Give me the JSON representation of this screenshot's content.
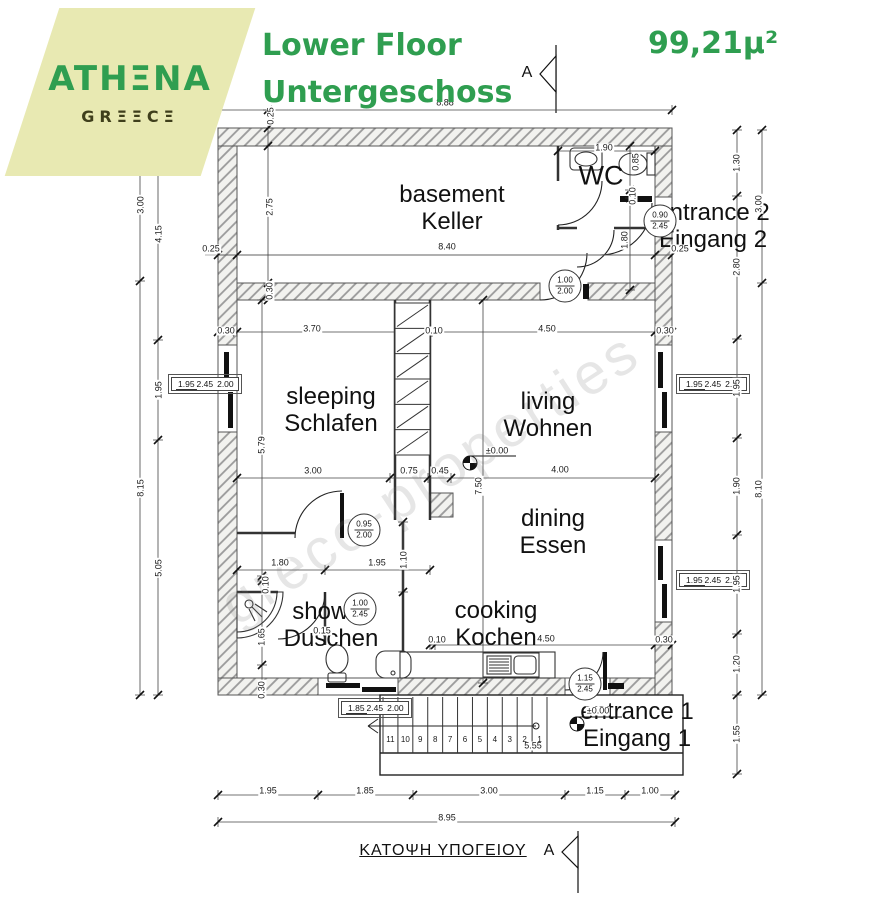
{
  "header": {
    "logo_line1": "ATHΞNA",
    "logo_line2": "GRΞΞCΞ",
    "title_line1": "Lower Floor",
    "title_line2": "Untergeschoss",
    "area": "99,21μ²"
  },
  "colors": {
    "accent_green": "#2f9e50",
    "logo_bg": "#e8e9b2",
    "logo_sub": "#3f3f1c"
  },
  "section_marker": {
    "top": "A",
    "bottom": "A"
  },
  "caption": "ΚΑΤΟΨΗ ΥΠΟΓΕΙΟΥ",
  "watermark": "greco-properties",
  "rooms": [
    {
      "en": "basement",
      "de": "Keller"
    },
    {
      "en": "WC",
      "de": ""
    },
    {
      "en": "entrance 2",
      "de": "Eingang 2"
    },
    {
      "en": "sleeping",
      "de": "Schlafen"
    },
    {
      "en": "living",
      "de": "Wohnen"
    },
    {
      "en": "dining",
      "de": "Essen"
    },
    {
      "en": "shower",
      "de": "Duschen"
    },
    {
      "en": "cooking",
      "de": "Kochen"
    },
    {
      "en": "entrance 1",
      "de": "Eingang 1"
    }
  ],
  "dim_labels": [
    "8.88",
    "0.25",
    "3.00",
    "8.15",
    "4.15",
    "1.95",
    "5.05",
    "2.75",
    "0.30",
    "0.25",
    "8.40",
    "0.30",
    "3.70",
    "0.10",
    "4.50",
    "0.30",
    "5.79",
    "3.00",
    "0.75",
    "0.45",
    "4.00",
    "7.50",
    "1.80",
    "1.95",
    "1.10",
    "0.10",
    "1.65",
    "0.30",
    "0.15",
    "0.10",
    "4.50",
    "0.30",
    "1.90",
    "0.85",
    "0.10",
    "1.80",
    "0.25",
    "1.30",
    "2.80",
    "1.95",
    "1.90",
    "1.95",
    "1.20",
    "1.55",
    "3.00",
    "8.10",
    "1.95",
    "1.85",
    "3.00",
    "1.15",
    "1.00",
    "8.95",
    "5.55",
    "±0.00",
    "±0.00"
  ],
  "door_labels": [
    {
      "w": "1.00",
      "h": "2.00"
    },
    {
      "w": "0.90",
      "h": "2.45"
    },
    {
      "w": "0.95",
      "h": "2.00"
    },
    {
      "w": "1.00",
      "h": "2.45"
    },
    {
      "w": "1.15",
      "h": "2.45"
    }
  ],
  "window_labels": [
    {
      "w": "1.95",
      "h": "2.45",
      "sill": "2.00"
    },
    {
      "w": "1.95",
      "h": "2.45",
      "sill": "2.00"
    },
    {
      "w": "1.95",
      "h": "2.45",
      "sill": "2.00"
    },
    {
      "w": "1.85",
      "h": "2.45",
      "sill": "2.00"
    }
  ],
  "stair_numbers": [
    "11",
    "10",
    "9",
    "8",
    "7",
    "6",
    "5",
    "4",
    "3",
    "2",
    "1"
  ]
}
